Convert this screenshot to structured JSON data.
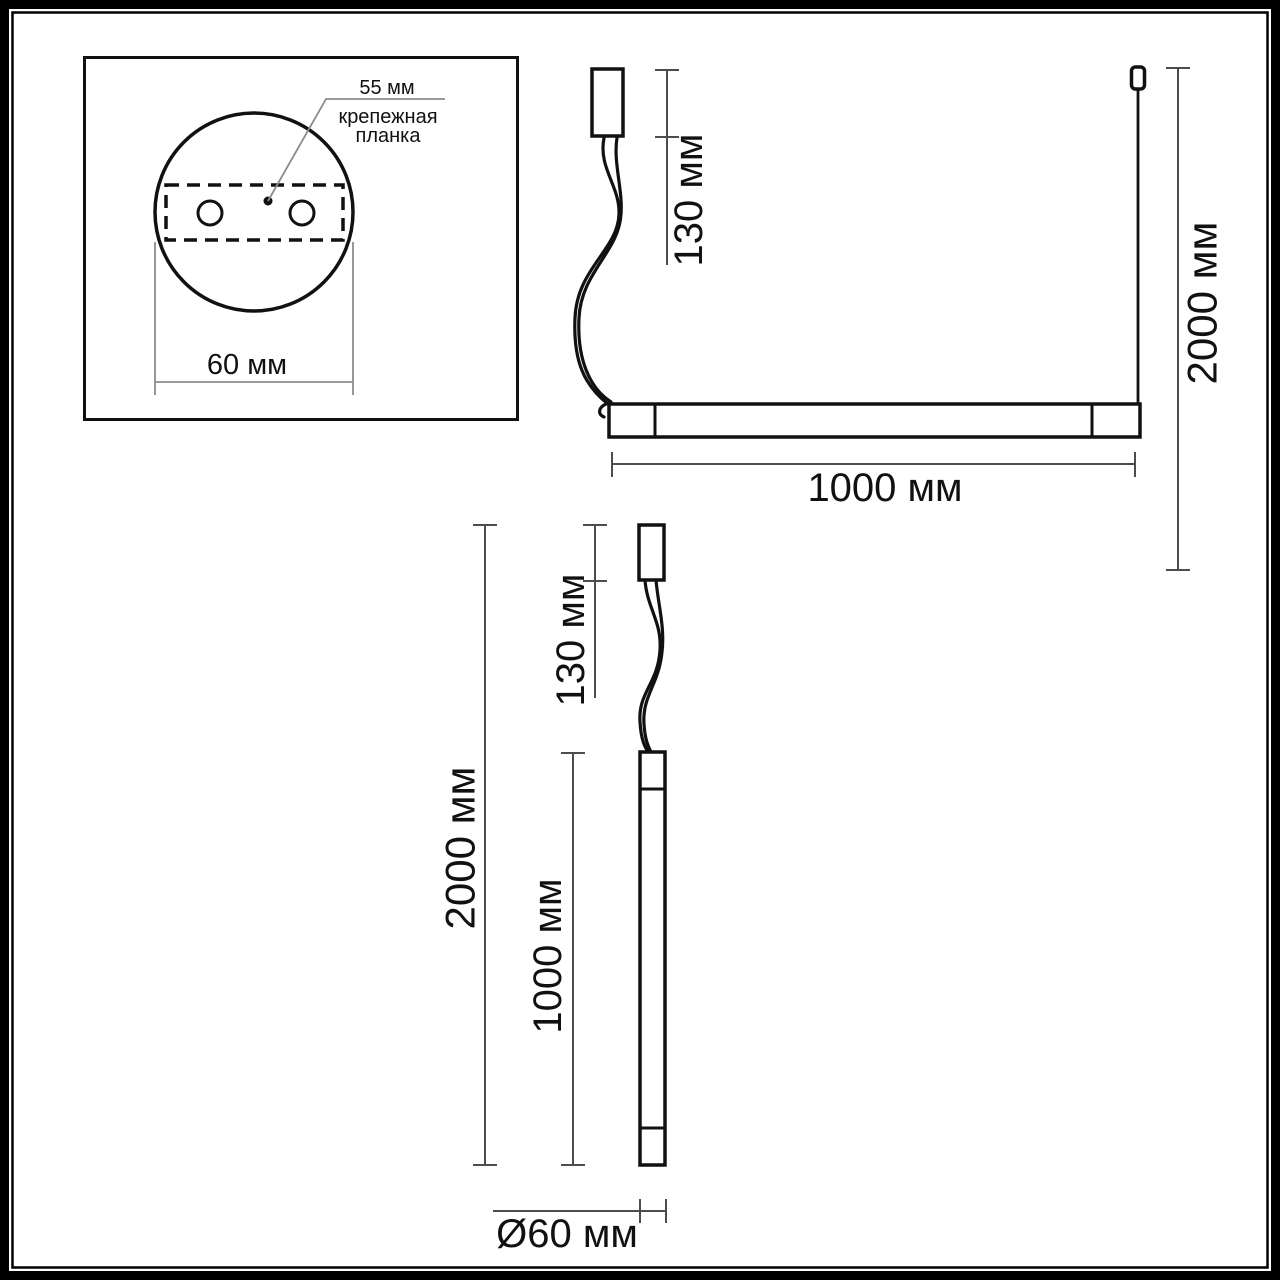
{
  "drawing": {
    "mount_detail": {
      "plate_offset_label": "55 мм",
      "plate_name_line1": "крепежная",
      "plate_name_line2": "планка",
      "canopy_diameter_label": "60 мм"
    },
    "horizontal_view": {
      "canopy_height_label": "130 мм",
      "suspension_height_label": "2000 мм",
      "fixture_length_label": "1000 мм"
    },
    "vertical_view": {
      "canopy_height_label": "130 мм",
      "suspension_height_label": "2000 мм",
      "fixture_length_label": "1000 мм",
      "tube_diameter_label": "Ø60 мм"
    },
    "colors": {
      "outline": "#111111",
      "dimension_line": "#4d4d4d",
      "leader_line": "#8c8c8c",
      "background": "#ffffff"
    }
  }
}
